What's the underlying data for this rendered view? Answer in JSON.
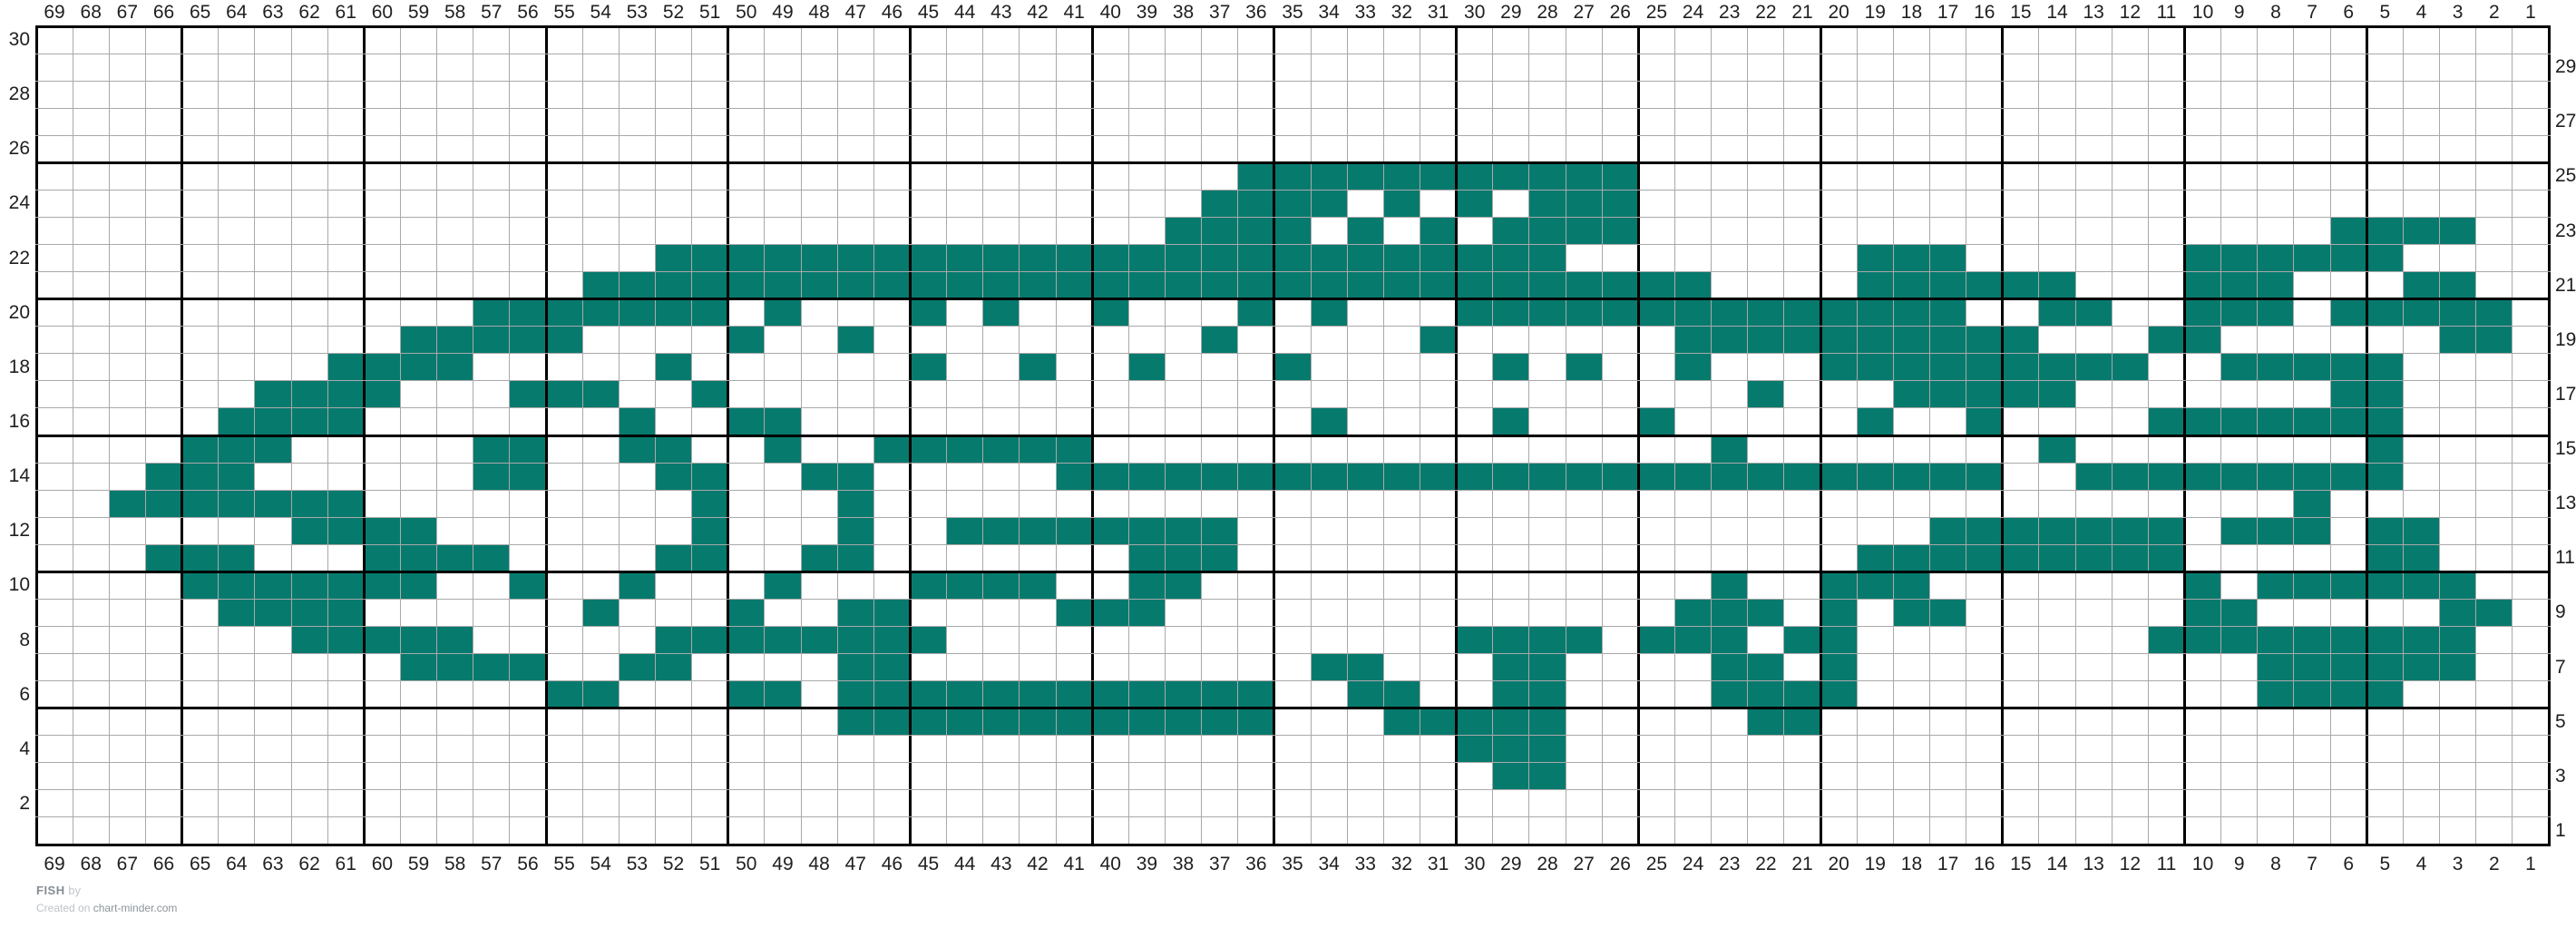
{
  "chart_data": {
    "type": "heatmap",
    "title": "FISH",
    "description": "Knitting colorwork chart, 69 columns x 30 rows, filled stitches form a fish facing left",
    "grid": {
      "columns": 69,
      "rows": 30
    },
    "fill_color": "#077a6e",
    "empty_color": "#ffffff",
    "thin_line_color": "#a9a9a9",
    "thick_line_color": "#000000",
    "label_color": "#1f1f1f",
    "column_labels_top": [
      69,
      68,
      67,
      66,
      65,
      64,
      63,
      62,
      61,
      60,
      59,
      58,
      57,
      56,
      55,
      54,
      53,
      52,
      51,
      50,
      49,
      48,
      47,
      46,
      45,
      44,
      43,
      42,
      41,
      40,
      39,
      38,
      37,
      36,
      35,
      34,
      33,
      32,
      31,
      30,
      29,
      28,
      27,
      26,
      25,
      24,
      23,
      22,
      21,
      20,
      19,
      18,
      17,
      16,
      15,
      14,
      13,
      12,
      11,
      10,
      9,
      8,
      7,
      6,
      5,
      4,
      3,
      2,
      1
    ],
    "column_labels_bottom": [
      69,
      68,
      67,
      66,
      65,
      64,
      63,
      62,
      61,
      60,
      59,
      58,
      57,
      56,
      55,
      54,
      53,
      52,
      51,
      50,
      49,
      48,
      47,
      46,
      45,
      44,
      43,
      42,
      41,
      40,
      39,
      38,
      37,
      36,
      35,
      34,
      33,
      32,
      31,
      30,
      29,
      28,
      27,
      26,
      25,
      24,
      23,
      22,
      21,
      20,
      19,
      18,
      17,
      16,
      15,
      14,
      13,
      12,
      11,
      10,
      9,
      8,
      7,
      6,
      5,
      4,
      3,
      2,
      1
    ],
    "row_labels_left": [
      30,
      28,
      26,
      24,
      22,
      20,
      18,
      16,
      14,
      12,
      10,
      8,
      6,
      4,
      2
    ],
    "row_labels_right": [
      29,
      27,
      25,
      23,
      21,
      19,
      17,
      15,
      13,
      11,
      9,
      7,
      5,
      3,
      1
    ],
    "pattern_rows_top_to_bottom": [
      "000000000000000000000000000000000000000000000000000000000000000000000",
      "000000000000000000000000000000000000000000000000000000000000000000000",
      "000000000000000000000000000000000000000000000000000000000000000000000",
      "000000000000000000000000000000000000000000000000000000000000000000000",
      "000000000000000000000000000000000000000000000000000000000000000000000",
      "000000000000000000000000000000000111111111110000000000000000000000000",
      "000000000000000000000000000000001111010101110000000000000000000000000",
      "000000000000000000000000000000011110101011110000000000000000000111100",
      "000000000000000001111111111111111111111111000000001110000001111110000",
      "000000000000000111111111111111111111111111111100001111110001110001100",
      "000000000000111111101000101001000101000111111111111110011001110111110",
      "000000000011111000010010000000001000001000000111111111100011000000110",
      "000000001111000001000000100100100010000010100100011111111100111110000",
      "000000111100011100100000000000000000000000000001000111110000000110",
      "000001111000000010011000000000000001000010001000001001000011111110000",
      "000011100000110011001001111110000000000000000010000000010000000010000",
      "000111000000110001100110000011111111111111111111111111001111111110000",
      "001111111000000000100010000000000000000000000000000000000000001000",
      "000000011110000000100010011111111000000000000000000011111110111011000",
      "000111000111100001100110000000111000000000000000001111111110000011000",
      "000011111110010010001000111100110000000000000010011100000001011111100",
      "000001111000000100010011000011100000000000000111010110000001100000110",
      "000000011111000001111111100000000000000111101110110000000011111111100",
      "000000000011110011000011000000000001100011000011010000000000011111100",
      "000000000000001100011011111111111100110011000011110000000000011110000",
      "000000000000000000000011111111111100011111000001100000000000000000000",
      "000000000000000000000000000000000000000111000000000000000000000000000",
      "000000000000000000000000000000000000000011000000000000000000000000000",
      "000000000000000000000000000000000000000000000000000000000000000000000",
      "000000000000000000000000000000000000000000000000000000000000000000000"
    ]
  },
  "footer": {
    "title": "FISH",
    "by_label": "by",
    "created_prefix": "Created on",
    "site": "chart-minder.com"
  }
}
